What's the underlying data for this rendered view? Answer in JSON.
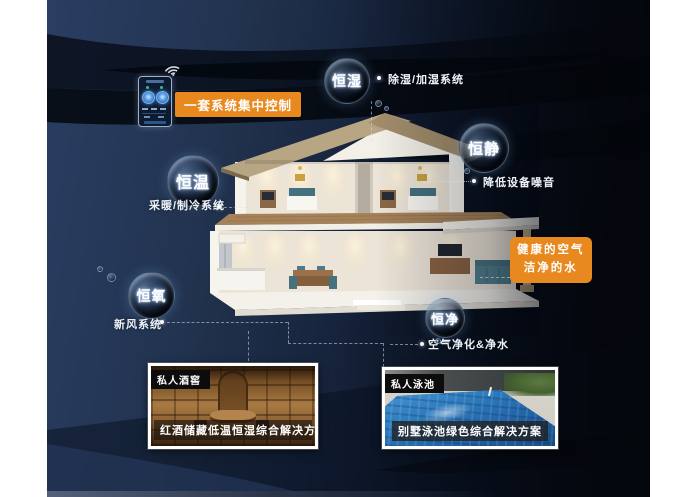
{
  "poster": {
    "control_label": "一套系统集中控制",
    "bubbles": [
      {
        "label": "恒湿",
        "note": "除湿/加湿系统"
      },
      {
        "label": "恒静",
        "note": "降低设备噪音"
      },
      {
        "label": "恒温",
        "note": "采暖/制冷系统"
      },
      {
        "label": "恒氧",
        "note": "新风系统"
      },
      {
        "label": "恒净",
        "note": "空气净化&净水"
      }
    ],
    "highlight": {
      "line1": "健康的空气",
      "line2": "洁净的水"
    },
    "cards": [
      {
        "tag": "私人酒窖",
        "caption": "红酒储藏低温恒湿综合解决方案"
      },
      {
        "tag": "私人泳池",
        "caption": "别墅泳池绿色综合解决方案"
      }
    ],
    "icons": {
      "wifi": "wifi-icon",
      "phone": "smart-home-controller"
    },
    "colors": {
      "accent_orange": "#E8891F",
      "background_navy": "#22334F",
      "background_dark": "#05080F",
      "bubble_text": "#FFFFFF",
      "card_border": "#FFFFFF",
      "pool_water": "#2F7EC0",
      "wine_wood": "#8A5F33"
    }
  }
}
